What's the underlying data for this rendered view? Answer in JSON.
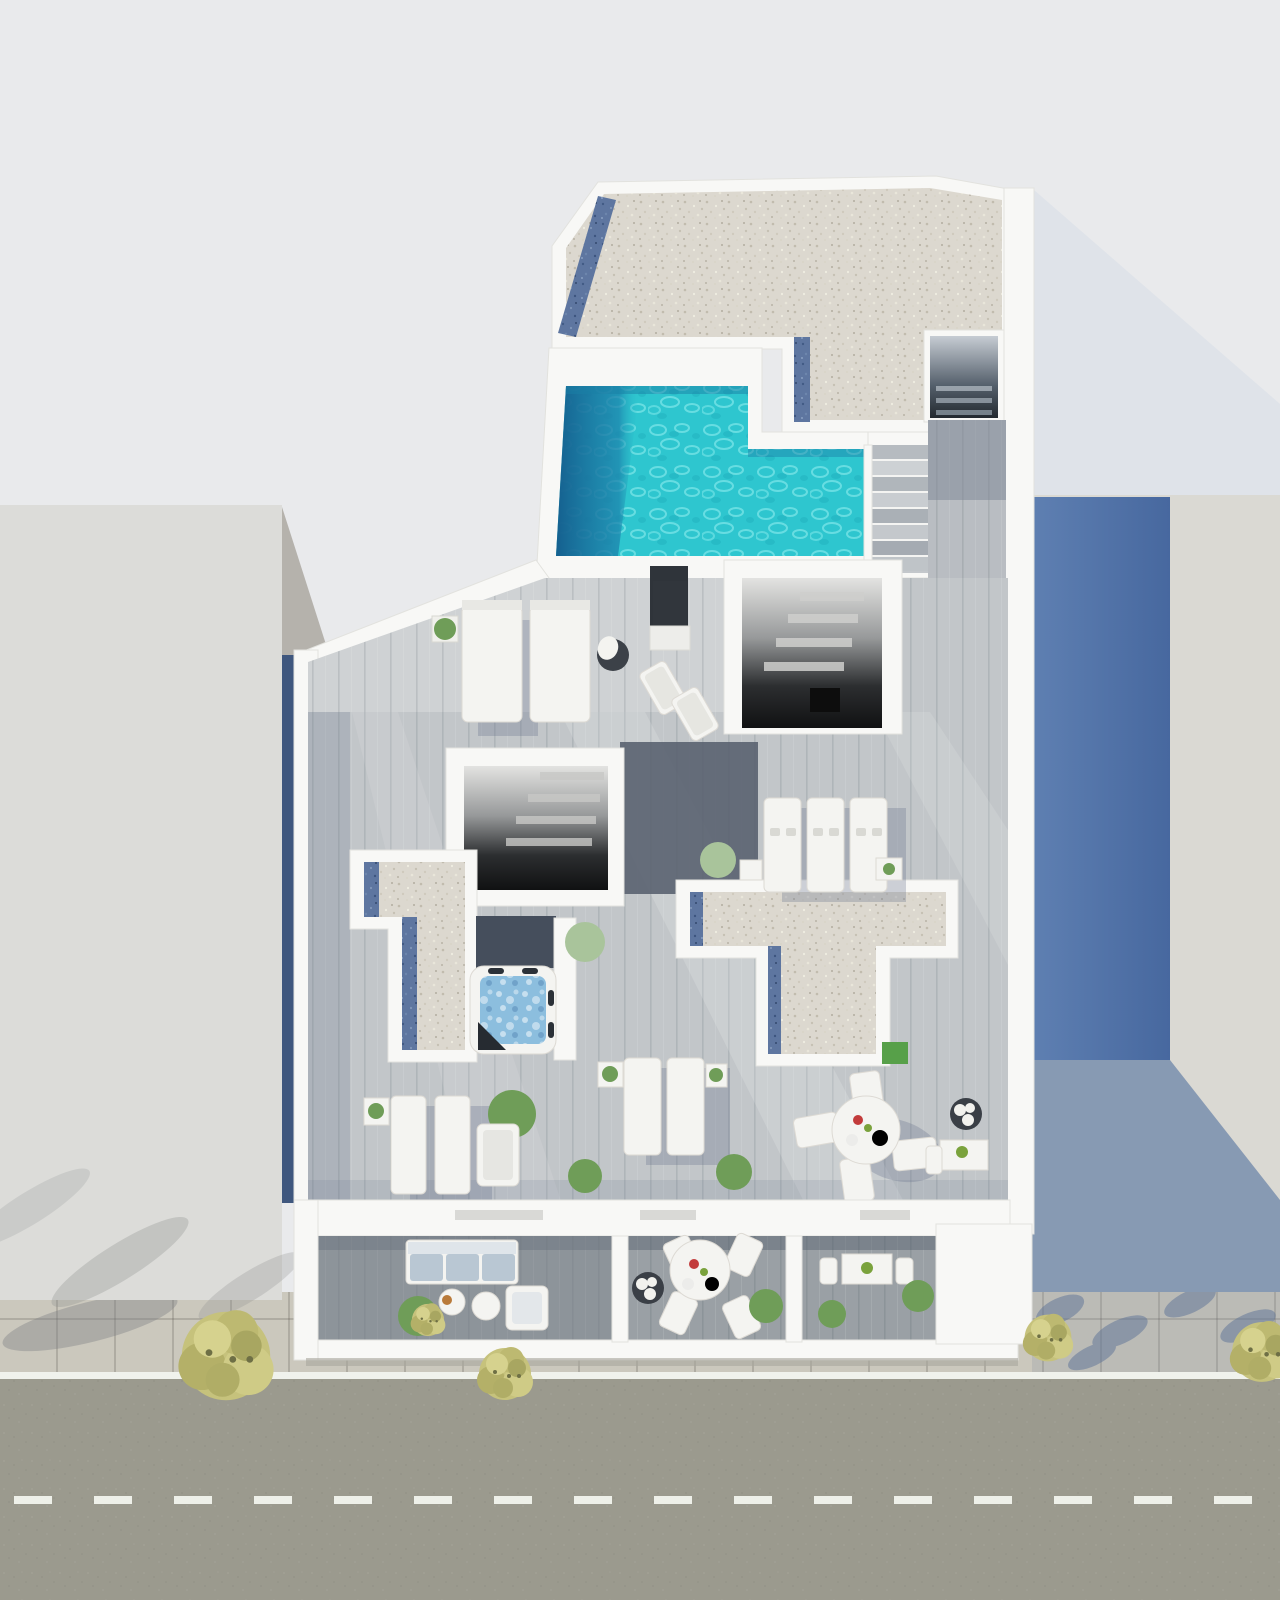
{
  "image": {
    "kind": "aerial top-down 3D architectural rendering",
    "subject": "Rooftop terrace of a modern apartment building with L-shaped swimming pool, gravel flat roofs, stairwell voids, wooden sun deck, jacuzzi, lounge furniture, lower balcony level and a street with sidewalk trees",
    "orientation": "street at bottom, neighbor rooftops left and right, sun from upper-left casting blue shadows to the right"
  },
  "colors": {
    "background": "#e9eaec",
    "background_shade": "#dce1e8",
    "wall": "#f8f8f6",
    "wall_edge": "#e2e2de",
    "neighbor_left": "#dcdcd9",
    "neighbor_side": "#b5b2ac",
    "neighbor_right": "#dad9d3",
    "shadow_blue": "#4e70a4",
    "gap_dark": "#3f577e",
    "gravel": "#dcd8cf",
    "gravel_blue": "#5e76a0",
    "pool_water": "#2ec6cf",
    "pool_deep": "#15608f",
    "deck_light": "#cfd2d4",
    "deck_mid": "#c2c6c9",
    "deck_shadow": "#5a6270",
    "walkway": "#b9bdc2",
    "balcony_deck": "#9aa0a5",
    "stair_light": "#c3c7cb",
    "street": "#9b9a8e",
    "road_line": "#f0f2ec",
    "sidewalk": "#cbc8bd",
    "tree": "#c6c27c",
    "plant": "#6f9d58",
    "plant_pale": "#a9c49b",
    "grass": "#57a049",
    "furniture": "#f4f4f1",
    "cushion": "#b9c7d3",
    "jacuzzi_water": "#8cbede",
    "planter_dark": "#3a3f46",
    "accent_red": "#c23b3b",
    "accent_green": "#7aa23c",
    "shadow_soft": "#66728a"
  },
  "scene": {
    "objects": [
      "left-neighbor-rooftop",
      "right-neighbor-rooftop",
      "building-cast-shadow",
      "gravel-roof-top",
      "blue-gravel-drainage-strips",
      "rooftop-stairwell-opening-top",
      "swimming-pool",
      "pool-deep-end",
      "pool-access-stairs",
      "deck-walkway",
      "stairwell-void-upper",
      "stairwell-void-center",
      "sun-deck",
      "daybeds",
      "lounge-chairs",
      "privacy-screen",
      "pouf-with-towel",
      "sun-loungers-row",
      "gravel-canopy-left",
      "gravel-canopy-center-T",
      "grass-patch",
      "jacuzzi",
      "potted-plants",
      "side-tables",
      "outdoor-dining-set",
      "dark-planter",
      "desk-set",
      "front-wall-with-window-slits",
      "balcony-terrace",
      "outdoor-sofa",
      "coffee-tables",
      "armchair",
      "balcony-round-dining-set",
      "balcony-bistro-set",
      "balcony-dividers",
      "sidewalk-pavers",
      "street-asphalt",
      "street-edge-line",
      "street-center-dashes",
      "street-trees"
    ]
  }
}
